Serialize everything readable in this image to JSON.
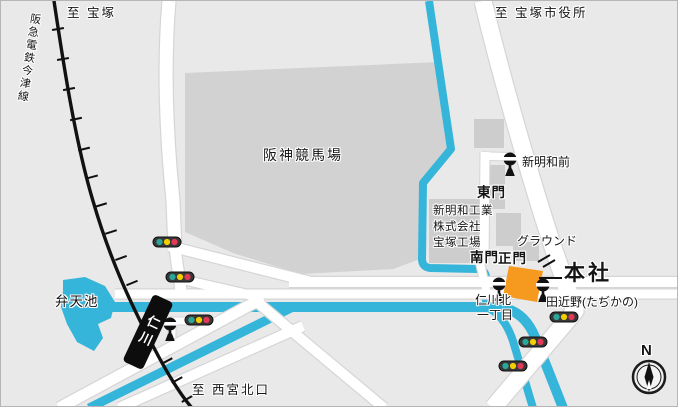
{
  "labels": {
    "to_takarazuka": "至 宝塚",
    "railway_line": "阪急電鉄今津線",
    "to_city_hall": "至 宝塚市役所",
    "racecourse": "阪神競馬場",
    "benten_pond": "弁天池",
    "shinmeiwa_mae": "新明和前",
    "east_gate": "東門",
    "company_line1": "新明和工業",
    "company_line2": "株式会社",
    "company_line3": "宝塚工場",
    "ground": "グラウンド",
    "south_gate": "南門",
    "main_gate": "正門",
    "head_office": "本社",
    "tajikano": "田近野(たぢかの)",
    "nigawakita_line1": "仁川北",
    "nigawakita_line2": "一丁目",
    "station": "仁川",
    "to_nishinomiya": "至 西宮北口",
    "north": "N"
  },
  "colors": {
    "background": "#e9e9e9",
    "racecourse_fill": "#d2d2d2",
    "building_fill": "#cdcdcd",
    "road_fill": "#ffffff",
    "water": "#35b5d9",
    "rail": "#111111",
    "head_office_building": "#f59a1e",
    "station_fill": "#0d0d0d",
    "traffic_green": "#2aa79c",
    "traffic_yellow": "#f2cf00",
    "traffic_red": "#e23a56"
  },
  "icons": {
    "bus_stop": "bus-stop-sign-icon",
    "traffic_light": "traffic-light-icon",
    "compass": "compass-north-icon",
    "gate_mark": "double-slash-gate-mark"
  }
}
